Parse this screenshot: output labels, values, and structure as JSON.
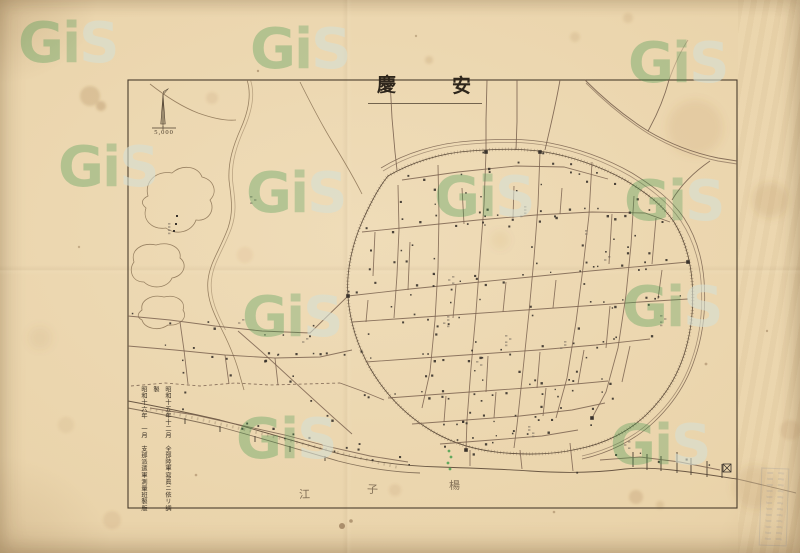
{
  "title": {
    "text": "安慶",
    "chars": [
      "安",
      "慶"
    ]
  },
  "scale": {
    "value": "5,000"
  },
  "credits": {
    "right_column": "昭和十五年十二月　全部陸軍寫眞ニ依リ調製",
    "left_column": "昭和十六年　一月　支那派遣軍測量班製版"
  },
  "river_label": {
    "name": "楊子江",
    "chars": [
      "楊",
      "子",
      "江"
    ]
  },
  "watermark": {
    "text": "GiS",
    "letters": [
      "G",
      "i",
      "S"
    ]
  },
  "colors": {
    "paper": "#ead4ab",
    "ink": "#4a3c2c",
    "street": "#7b6350",
    "wall": "#5d4c3a",
    "water_outline": "#8a7254",
    "building_dot": "#3a332c",
    "green_mark": "#3f9e4a",
    "watermark_green": "#3a944a"
  }
}
